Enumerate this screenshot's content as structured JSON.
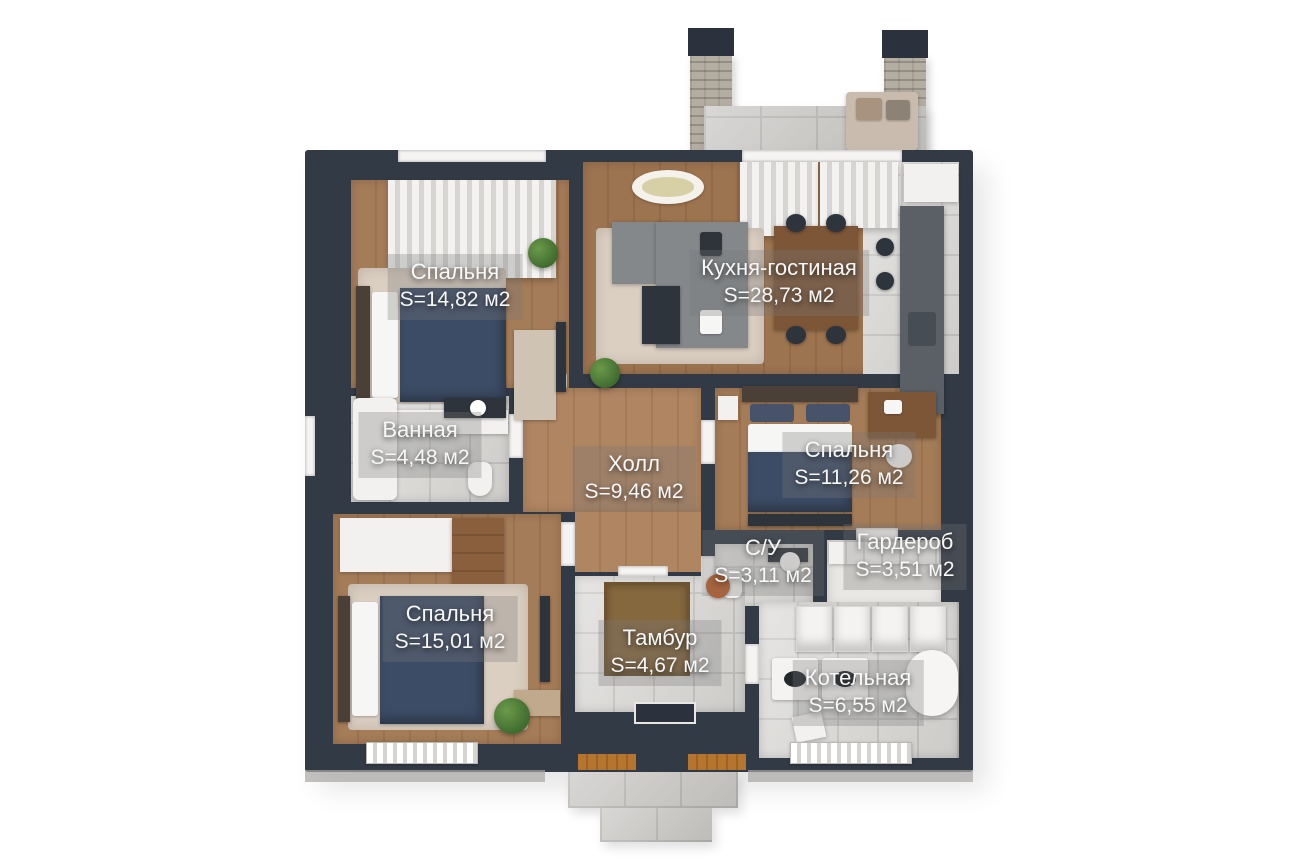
{
  "plan_type": "3d-floor-plan",
  "language": "ru",
  "rooms": [
    {
      "id": "bedroom-top-left",
      "name": "Спальня",
      "area": "S=14,82 м2"
    },
    {
      "id": "kitchen-living",
      "name": "Кухня-гостиная",
      "area": "S=28,73 м2"
    },
    {
      "id": "bathroom",
      "name": "Ванная",
      "area": "S=4,48 м2"
    },
    {
      "id": "hall",
      "name": "Холл",
      "area": "S=9,46 м2"
    },
    {
      "id": "bedroom-right",
      "name": "Спальня",
      "area": "S=11,26 м2"
    },
    {
      "id": "wc",
      "name": "С/У",
      "area": "S=3,11 м2"
    },
    {
      "id": "wardrobe",
      "name": "Гардероб",
      "area": "S=3,51 м2"
    },
    {
      "id": "bedroom-bottom-left",
      "name": "Спальня",
      "area": "S=15,01 м2"
    },
    {
      "id": "vestibule",
      "name": "Тамбур",
      "area": "S=4,67 м2"
    },
    {
      "id": "boiler-room",
      "name": "Котельная",
      "area": "S=6,55 м2"
    }
  ],
  "colors": {
    "wall": "#323a46",
    "wood_floor": "#a57c58",
    "marble_floor": "#d9d8d5",
    "terrace_tile": "#c8c6c3",
    "brick_chimney": "#b4ada1",
    "bed_duvet": "#3d4c66",
    "sofa": "#85888b",
    "plant": "#4e7d3a",
    "label_text": "#f7f7f7"
  }
}
